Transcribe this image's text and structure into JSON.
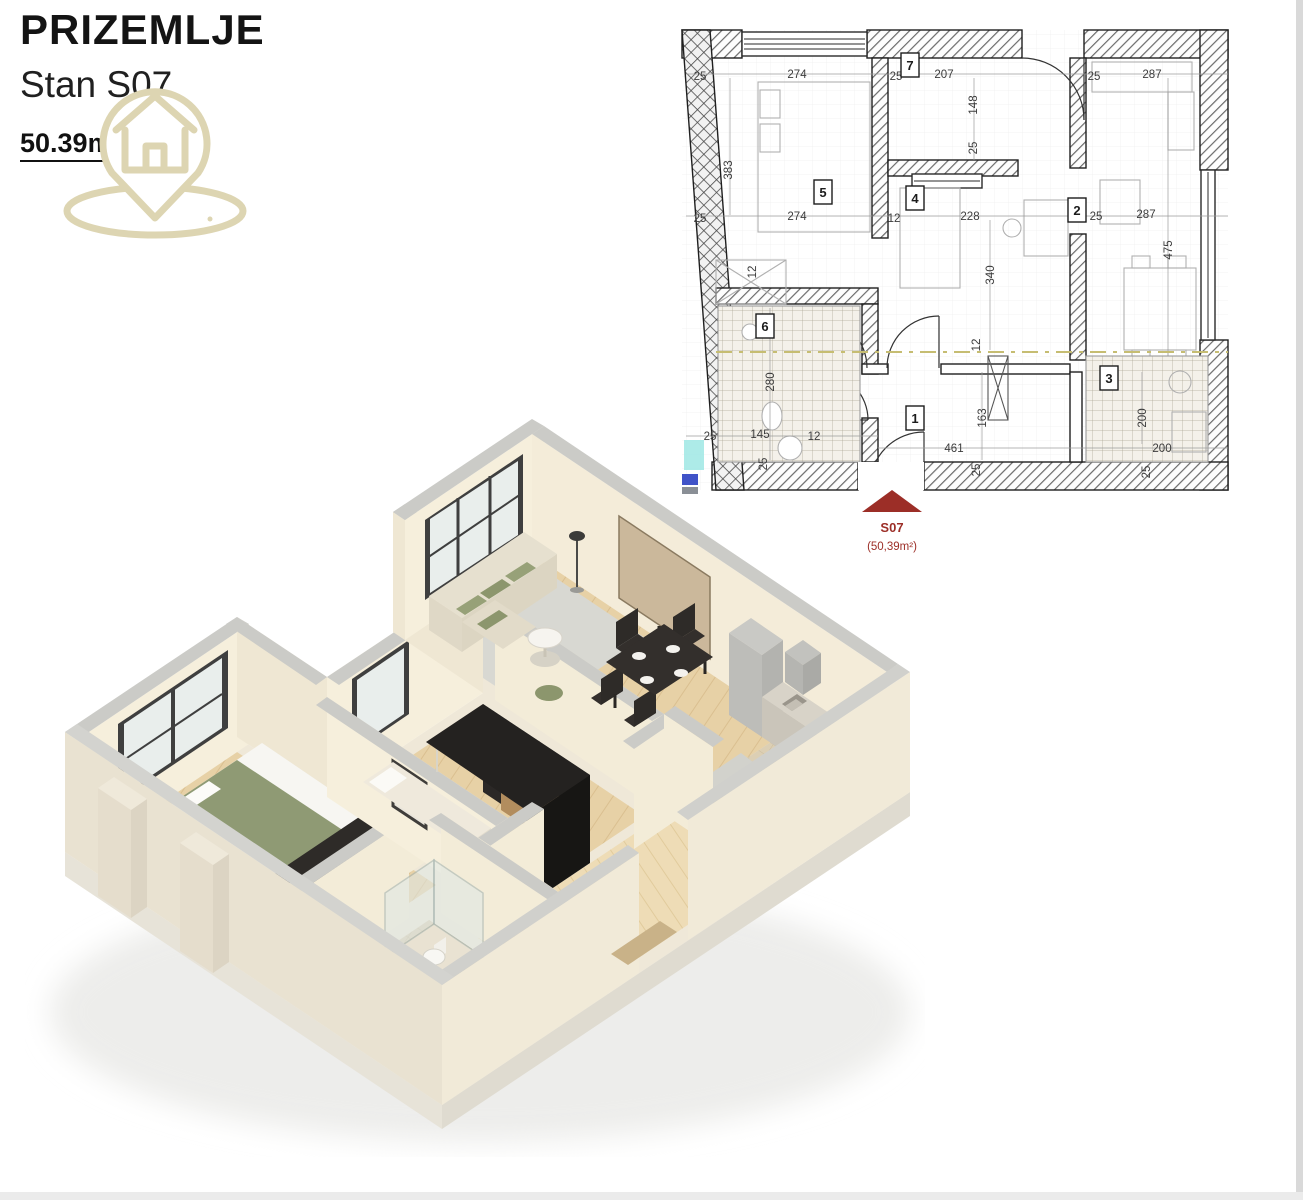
{
  "header": {
    "title": "PRIZEMLJE",
    "subtitle": "Stan S07",
    "area_value": "50.39",
    "area_unit": "m",
    "area_sup": "2"
  },
  "logo": {
    "icon": "house-location-pin",
    "color": "#ddd5b2"
  },
  "plan": {
    "entry": {
      "label": "S07",
      "area": "(50,39m²)",
      "color": "#9c2e27"
    },
    "room_markers": [
      "1",
      "2",
      "3",
      "4",
      "5",
      "6",
      "7"
    ],
    "dims": [
      "25",
      "274",
      "383",
      "25",
      "274",
      "25",
      "207",
      "148",
      "25",
      "12",
      "228",
      "340",
      "12",
      "25",
      "287",
      "25",
      "287",
      "475",
      "12",
      "280",
      "25",
      "145",
      "12",
      "25",
      "163",
      "461",
      "25",
      "200",
      "200",
      "25"
    ],
    "axis_color": "#c6bd72",
    "highlight_color": "#8fe3de",
    "wall_hatch_color": "#6a6a6a"
  },
  "render": {
    "style": "3d-isometric-apartment",
    "wall_color": "#f4edda",
    "floor_wood": "#e8d2a8",
    "floor_tile": "#dbceb2",
    "accent_green": "#97a178"
  }
}
